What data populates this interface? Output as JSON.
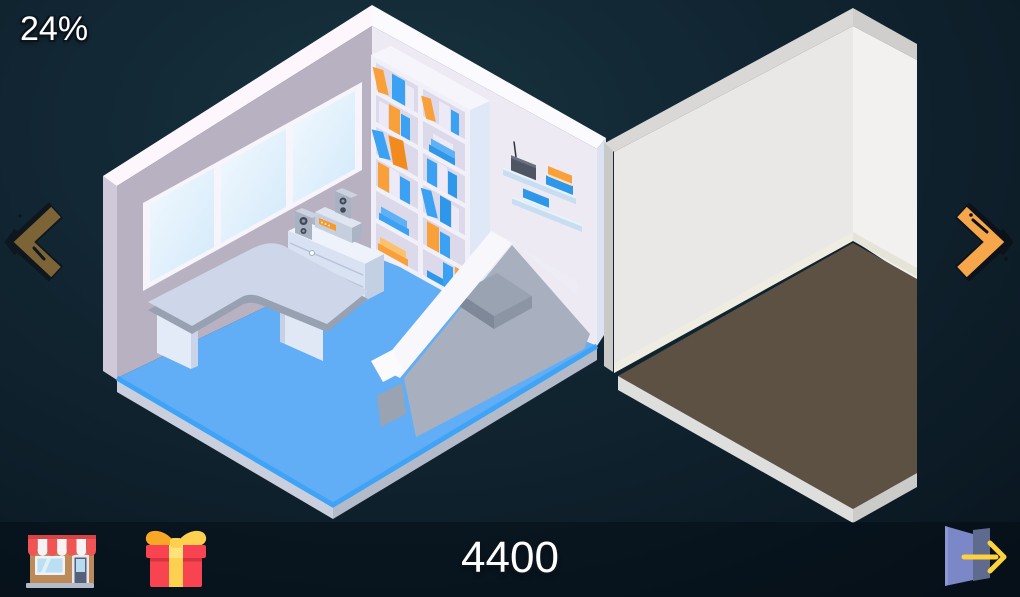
{
  "hud": {
    "progress": "24%",
    "score": "4400"
  },
  "nav": {
    "prev_label": "previous-room",
    "next_label": "next-room",
    "prev_color": "#7d6436",
    "next_color": "#f6a64b"
  },
  "toolbar": {
    "shop": "storefront-shop",
    "gift": "daily-gift",
    "exit": "exit-door"
  },
  "scene": {
    "room_current": {
      "name": "furnished office room",
      "floor_color": "#61aef6",
      "wall_left_color": "#b7b1c1",
      "wall_right_color": "#edeaf4",
      "items": [
        "panoramic-window",
        "bookshelf-with-books",
        "wall-shelf-router",
        "wall-shelf-book",
        "corner-desk",
        "drawer-cabinet",
        "stereo-system",
        "corner-sofa"
      ]
    },
    "room_next": {
      "name": "empty room",
      "floor_color": "#5d5144",
      "wall_left_color": "#e9e8e6",
      "wall_right_color": "#f2f1ef",
      "items": []
    }
  }
}
